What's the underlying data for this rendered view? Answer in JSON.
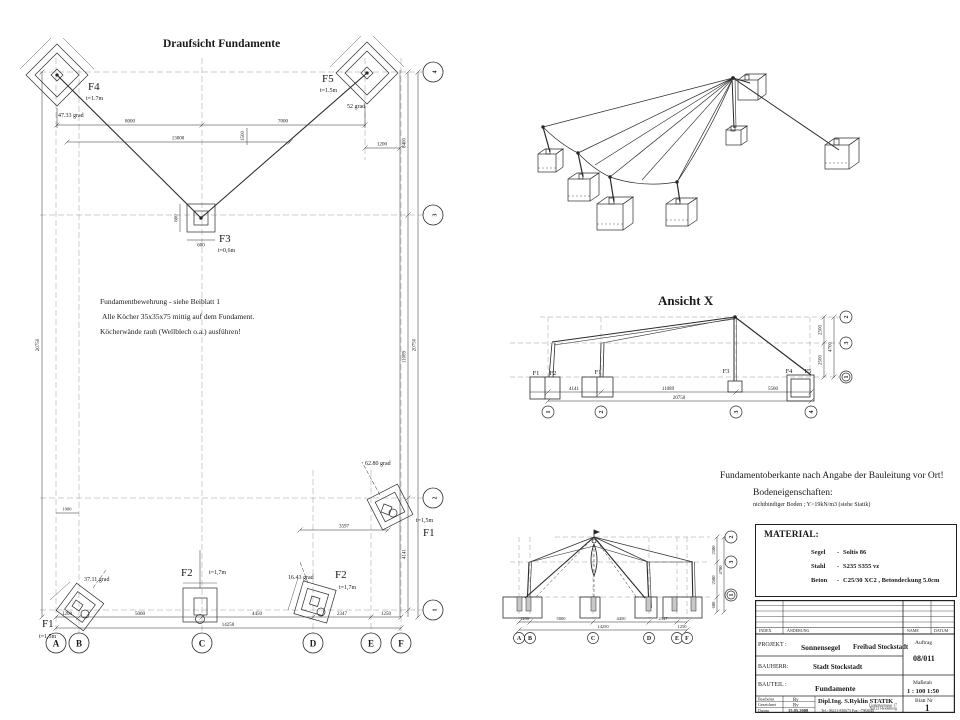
{
  "drawing": {
    "plan": {
      "title": "Draufsicht Fundamente",
      "f4": "F4",
      "f4_t": "t=1.7m",
      "f4_angle": "47.33 grad",
      "f5": "F5",
      "f5_t": "t=1.5m",
      "f5_angle": "52 grad",
      "f3": "F3",
      "f3_t": "t=0,6m",
      "f1l": "F1",
      "f1l_t": "t=1,5m",
      "f1l_angle": "37.11 grad",
      "f2l": "F2",
      "f2l_t": "t=1,7m",
      "f2r": "F2",
      "f2r_t": "t=1,7m",
      "f2r_angle": "16.43 grad",
      "f1r": "F1",
      "f1r_t": "t=1,5m",
      "f1r_angle": "62.80 grad",
      "note1": "Fundamentbewehrung  - siehe Beiblatt 1",
      "note2": "Alle Köcher 35x35x75 mittig auf dem Fundament.",
      "note3": "Köcherwände rauh (Wellblech o.a.) ausführen!",
      "rows": [
        "4",
        "3",
        "2",
        "1"
      ],
      "cols": [
        "A",
        "B",
        "C",
        "D",
        "E",
        "F"
      ],
      "dims": {
        "top1": "8000",
        "top2": "7000",
        "top3": "13000",
        "top4": "1200",
        "top5": "1500",
        "left1": "20750",
        "left2": "1900",
        "right1": "8400",
        "right2": "11089",
        "right3": "4141",
        "right_total": "20750",
        "bot1": "1200",
        "bot2": "5000",
        "bot3": "4450",
        "bot4": "2347",
        "bot5": "1250",
        "bot_total": "14250",
        "f3w": "600",
        "f3h": "600",
        "f1r_off": "3597"
      }
    },
    "ansicht_x": {
      "title": "Ansicht X",
      "base1a": "F1",
      "base1b": "F2",
      "base2": "F1",
      "base3": "F3",
      "base4a": "F4",
      "base4b": "F5",
      "dims": {
        "d1": "4141",
        "d2": "11089",
        "d3": "5500",
        "total": "20750",
        "v1": "2500",
        "v2": "2500",
        "v_total": "4700"
      },
      "axis": [
        "1",
        "2",
        "3",
        "4"
      ],
      "levels": [
        "2",
        "3",
        "1"
      ]
    },
    "elev_front": {
      "dims": {
        "d1": "1200",
        "d2": "5000",
        "d3": "4450",
        "d4": "2347",
        "d5": "1250",
        "total": "14250",
        "v1": "2500",
        "v2": "2500",
        "v3": "600",
        "v_total": "4700"
      },
      "axis": [
        "A",
        "B",
        "C",
        "D",
        "E",
        "F"
      ],
      "levels": [
        "2",
        "3",
        "1"
      ]
    }
  },
  "site_notes": {
    "line1": "Fundamentoberkante nach Angabe der Bauleitung vor Ort!",
    "line2": "Bodeneigenschaften:",
    "line3": "nichtbindiger Boden ; Y>19kN/m3 (siehe Statik)"
  },
  "material": {
    "title": "MATERIAL:",
    "r1k": "Segel",
    "r1s": "-",
    "r1v": "Soltis 86",
    "r2k": "Stahl",
    "r2s": "-",
    "r2v": "S235 S355 vz",
    "r3k": "Beton",
    "r3s": "-",
    "r3v": "C25/30 XC2 , Betondeckung 5.0cm"
  },
  "titleblock": {
    "h_index": "INDEX",
    "h_aenderung": "ÄNDERUNG",
    "h_name": "NAME",
    "h_datum": "DATUM",
    "projekt_label": "PROJEKT :",
    "projekt1": "Sonnensegel",
    "projekt2": "Freibad Stockstadt",
    "auftrag_label": "Auftrag",
    "auftrag": "08/011",
    "bauherr_label": "BAUHERR:",
    "bauherr": "Stadt Stockstadt",
    "bauteil_label": "BAUTEIL :",
    "bauteil": "Fundamente",
    "massstab_label": "Maßstab",
    "massstab": "1 : 100 1:50",
    "bearbeitet_label": "Bearbeitet",
    "bearbeitet": "Ry",
    "gezeichnet_label": "Gezeichnet",
    "gezeichnet": "Ry",
    "datum_label": "Datum",
    "datum": "15.05.2008",
    "firma": "Dipl.Ing. S.Ryklin STATIK",
    "adresse1": "Liselottestrasse 17",
    "adresse2": "69123 Heidelberg",
    "tel": "Tel.: 06221-830673  Fax: -7963048",
    "blatt_label": "Blatt Nr",
    "blatt": "1"
  }
}
